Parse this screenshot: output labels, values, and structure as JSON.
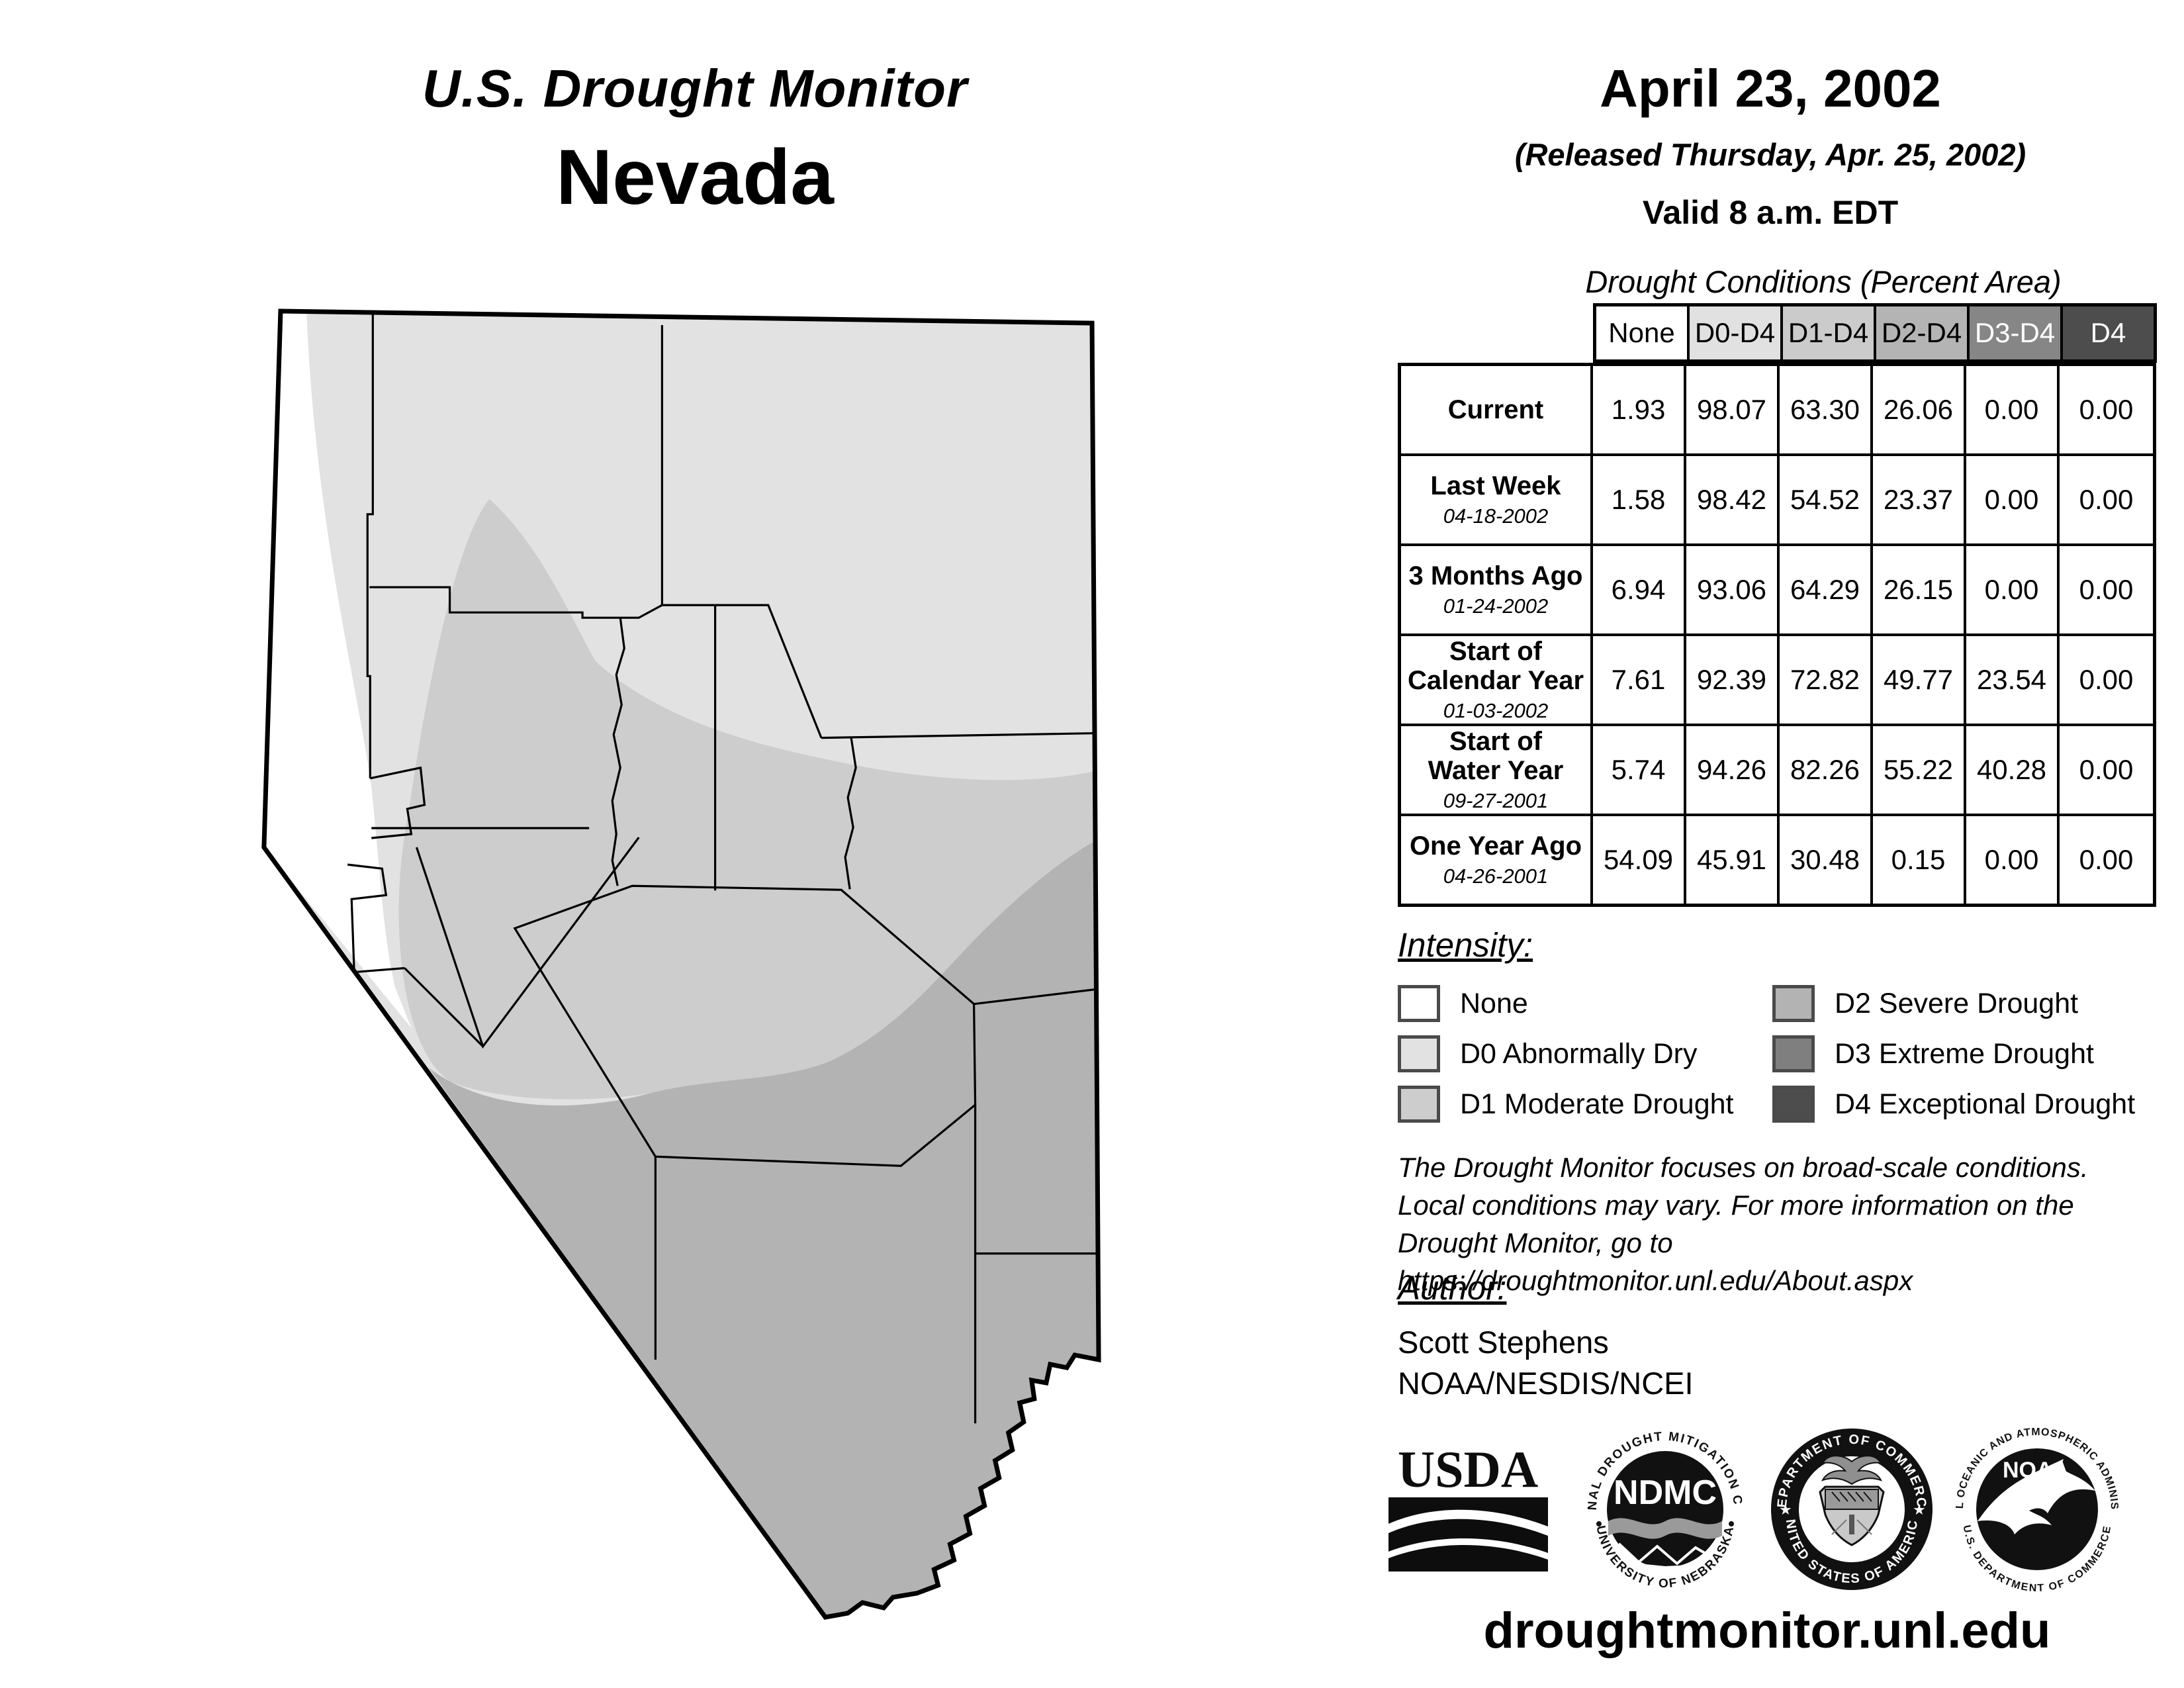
{
  "header": {
    "title": "U.S. Drought Monitor",
    "state": "Nevada",
    "date": "April 23, 2002",
    "released": "(Released Thursday, Apr. 25, 2002)",
    "valid": "Valid 8 a.m. EDT"
  },
  "table": {
    "title": "Drought Conditions (Percent Area)",
    "columns": [
      "None",
      "D0-D4",
      "D1-D4",
      "D2-D4",
      "D3-D4",
      "D4"
    ],
    "column_colors": [
      "#ffffff",
      "#e1e1e1",
      "#cbcbcb",
      "#b4b4b4",
      "#868686",
      "#4d4d4d"
    ],
    "column_text_colors": [
      "#000000",
      "#000000",
      "#000000",
      "#000000",
      "#ffffff",
      "#ffffff"
    ],
    "rows": [
      {
        "label": "Current",
        "date": "",
        "values": [
          "1.93",
          "98.07",
          "63.30",
          "26.06",
          "0.00",
          "0.00"
        ]
      },
      {
        "label": "Last Week",
        "date": "04-18-2002",
        "values": [
          "1.58",
          "98.42",
          "54.52",
          "23.37",
          "0.00",
          "0.00"
        ]
      },
      {
        "label": "3 Months Ago",
        "date": "01-24-2002",
        "values": [
          "6.94",
          "93.06",
          "64.29",
          "26.15",
          "0.00",
          "0.00"
        ]
      },
      {
        "label": "Start of\nCalendar Year",
        "date": "01-03-2002",
        "values": [
          "7.61",
          "92.39",
          "72.82",
          "49.77",
          "23.54",
          "0.00"
        ]
      },
      {
        "label": "Start of\nWater Year",
        "date": "09-27-2001",
        "values": [
          "5.74",
          "94.26",
          "82.26",
          "55.22",
          "40.28",
          "0.00"
        ]
      },
      {
        "label": "One Year Ago",
        "date": "04-26-2001",
        "values": [
          "54.09",
          "45.91",
          "30.48",
          "0.15",
          "0.00",
          "0.00"
        ]
      }
    ]
  },
  "legend": {
    "title": "Intensity:",
    "items": [
      {
        "label": "None",
        "color": "#ffffff"
      },
      {
        "label": "D0 Abnormally Dry",
        "color": "#e2e2e2"
      },
      {
        "label": "D1 Moderate Drought",
        "color": "#cdcdcd"
      },
      {
        "label": "D2 Severe Drought",
        "color": "#b3b3b3"
      },
      {
        "label": "D3 Extreme Drought",
        "color": "#7f7f7f"
      },
      {
        "label": "D4 Exceptional Drought",
        "color": "#4d4d4d"
      }
    ]
  },
  "disclaimer": {
    "lines": [
      "The Drought Monitor focuses on broad-scale conditions.",
      "Local conditions may vary. For more information on the",
      "Drought Monitor, go to https://droughtmonitor.unl.edu/About.aspx"
    ]
  },
  "author": {
    "title": "Author:",
    "name": "Scott Stephens",
    "org": "NOAA/NESDIS/NCEI"
  },
  "logos": {
    "usda": {
      "text": "USDA"
    },
    "ndmc": {
      "center": "NDMC",
      "ring_top": "NATIONAL DROUGHT MITIGATION CENTER",
      "ring_bottom": "UNIVERSITY OF NEBRASKA"
    },
    "doc": {
      "ring_top": "DEPARTMENT OF COMMERCE",
      "ring_bottom": "UNITED STATES OF AMERICA"
    },
    "noaa": {
      "center": "NOAA",
      "ring_top": "NATIONAL OCEANIC AND ATMOSPHERIC ADMINISTRATION",
      "ring_bottom": "U.S. DEPARTMENT OF COMMERCE"
    }
  },
  "footer": {
    "url": "droughtmonitor.unl.edu"
  },
  "map": {
    "region": "Nevada",
    "colors": {
      "none": "#ffffff",
      "d0": "#e2e2e2",
      "d1": "#cdcdcd",
      "d2": "#b3b3b3"
    },
    "outline_color": "#000000",
    "county_line_color": "#000000"
  }
}
